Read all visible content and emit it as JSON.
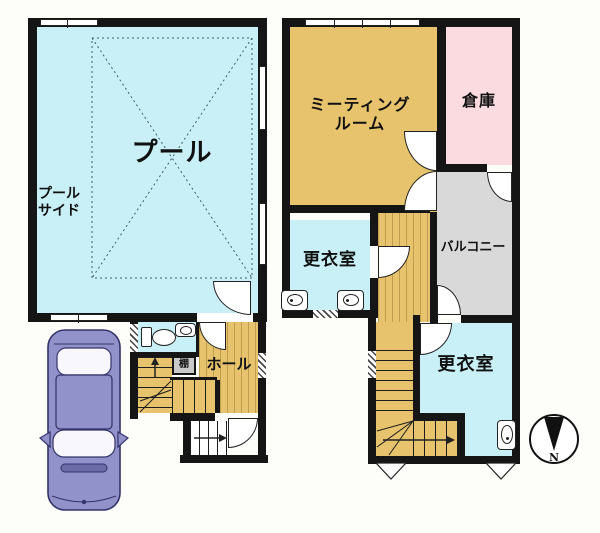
{
  "title": "2-story pool building floor plan",
  "rooms": {
    "pool": "プール",
    "poolside": "プール\nサイド",
    "meeting_room": "ミーティング\nルーム",
    "storage": "倉庫",
    "balcony": "バルコニー",
    "changing_room_middle": "更衣室",
    "changing_room_lower": "更衣室",
    "hall": "ホール",
    "shelf": "棚"
  },
  "compass": {
    "north_label": "N"
  },
  "icons": {
    "car": "top-view-car-icon",
    "compass": "north-arrow-compass-icon",
    "toilet": "toilet-icon",
    "washbasin": "washbasin-icon"
  },
  "colors": {
    "wall": "#151515",
    "water_room": "#c8f0f6",
    "wood_room": "#e6c36c",
    "storage_pink": "#fbdbdf",
    "balcony_gray": "#d9d9d9",
    "shelf_gray": "#c9c9c9",
    "car_body": "#9292cb"
  }
}
